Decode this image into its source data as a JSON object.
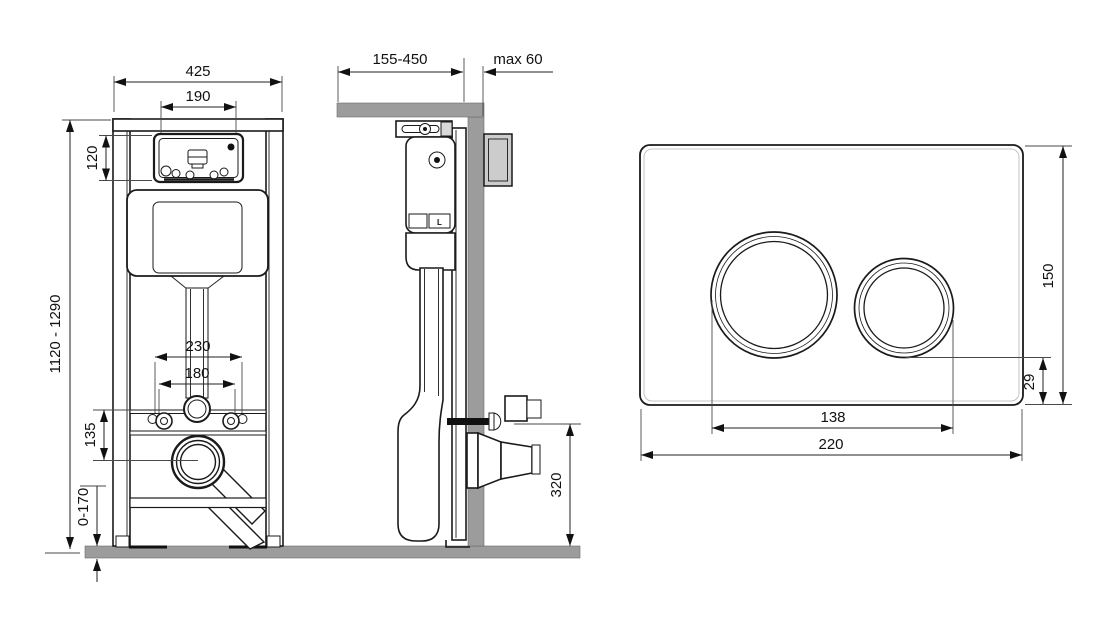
{
  "drawing": {
    "type": "wc-concealed-frame-installation-diagram",
    "colors": {
      "line": "#1a1a1a",
      "masonry_gray": "#9c9c9c",
      "background": "#ffffff"
    }
  },
  "views": {
    "front": {
      "dims": {
        "total_width": "425",
        "window_width": "190",
        "window_height": "120",
        "total_height": "1120 - 1290",
        "outer_bolt_span": "230",
        "inner_bolt_span": "180",
        "bolt_to_outlet": "135",
        "floor_adjust": "0-170"
      }
    },
    "side": {
      "dims": {
        "bracket_depth_range": "155-450",
        "wall_finish_max": "max 60",
        "outlet_height": "320"
      },
      "labels": {
        "valve_mark": "L"
      }
    },
    "plate": {
      "dims": {
        "height": "150",
        "button_bottom_offset": "29",
        "button_span": "138",
        "width": "220"
      }
    }
  }
}
